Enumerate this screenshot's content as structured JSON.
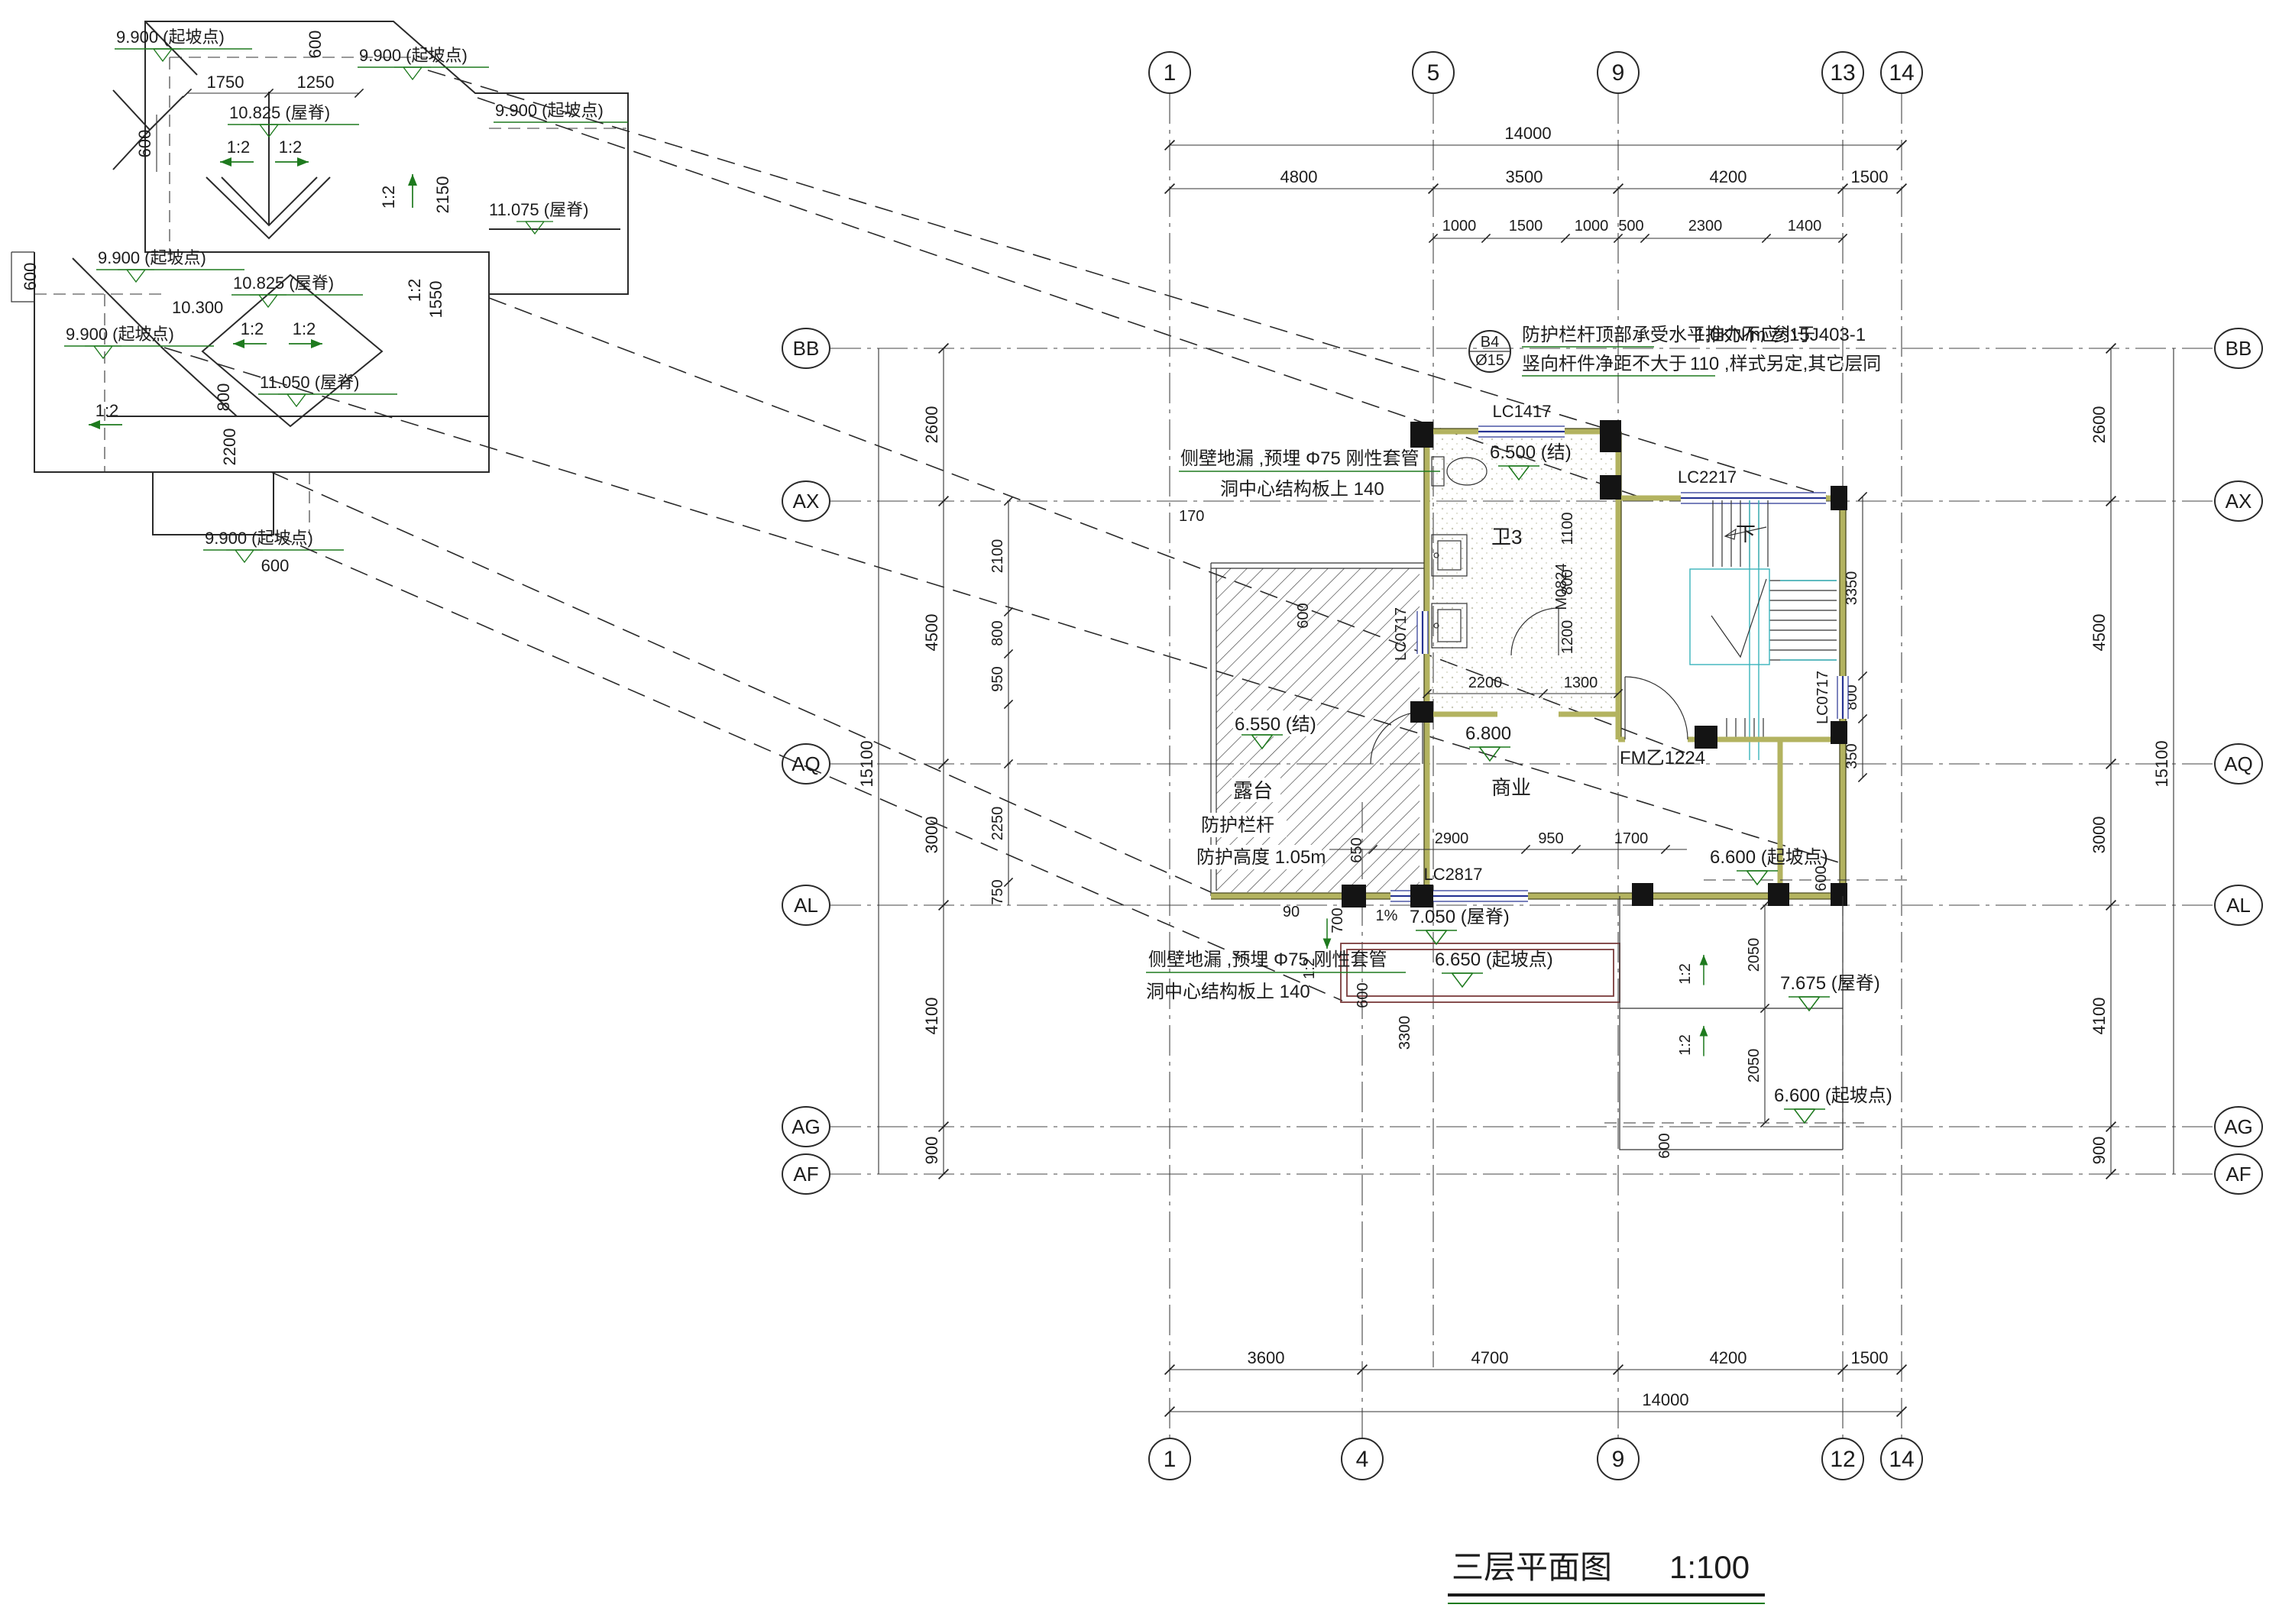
{
  "title": {
    "text": "三层平面图",
    "scale": "1:100"
  },
  "grid": {
    "t0": "1",
    "t1": "5",
    "t2": "9",
    "t3": "13",
    "t4": "14",
    "b0": "1",
    "b1": "4",
    "b2": "9",
    "b3": "12",
    "b4": "14",
    "l0": "BB",
    "l1": "AX",
    "l2": "AQ",
    "l3": "AL",
    "l4": "AG",
    "l5": "AF"
  },
  "dims": {
    "top_total": "14000",
    "bot_total": "14000",
    "t0": "4800",
    "t1": "3500",
    "t2": "4200",
    "t3": "1500",
    "s0": "1000",
    "s1": "1500",
    "s2": "1000",
    "s3": "500",
    "s4": "2300",
    "s5": "1400",
    "b0": "3600",
    "b1": "4700",
    "b2": "4200",
    "b3": "1500",
    "v_total": "15100",
    "v0": "2600",
    "v1": "4500",
    "v2": "3000",
    "v3": "4100",
    "v4": "900",
    "i0": "2100",
    "i1": "800",
    "i2": "950",
    "i3": "2250",
    "i4": "750",
    "r0": "3350",
    "r1": "800",
    "r2": "350",
    "rf0": "2050",
    "rf1": "2050",
    "p2200": "2200",
    "p1300": "1300",
    "p1200": "1200",
    "p1100": "1100",
    "p800": "800",
    "p2900": "2900",
    "p950": "950",
    "p1700": "1700",
    "p650": "650",
    "p90": "90",
    "p700": "700",
    "p600": "600",
    "p3300": "3300",
    "p170": "170",
    "p350": "350"
  },
  "rooms": {
    "bath": "卫3",
    "biz": "商业",
    "terrace": "露台",
    "down": "下"
  },
  "levels": {
    "v6500": "6.500 (结)",
    "v6550": "6.550 (结)",
    "v6800": "6.800",
    "v6600": "6.600 (起坡点)",
    "v6650": "6.650 (起坡点)",
    "v7050": "7.050 (屋脊)",
    "v7675": "7.675 (屋脊)"
  },
  "openings": {
    "lc1417": "LC1417",
    "lc2217": "LC2217",
    "lc0717": "LC0717",
    "lc2817": "LC2817",
    "m0824": "M0824",
    "fm": "FM乙1224"
  },
  "notes": {
    "bub_a": "B4",
    "bub_b": "Ø15",
    "n1": "防护栏杆顶部承受水平推力不应小于",
    "n1v": "1.0KN/m  参15J403-1",
    "n2": "竖向杆件净距不大于",
    "n2v": "110 ,样式另定,其它层同",
    "drain1": "侧壁地漏 ,预埋 Φ75 刚性套管",
    "drain2": "洞中心结构板上    140",
    "rail1": "防护栏杆",
    "rail2": "防护高度 1.05m",
    "slope": "1:2",
    "slope1p": "1%"
  },
  "roof": {
    "p9900": "9.900 (起坡点)",
    "p10825": "10.825 (屋脊)",
    "p11075": "11.075 (屋脊)",
    "p11050": "11.050 (屋脊)",
    "p10300": "10.300",
    "d600": "600",
    "d1750": "1750",
    "d1250": "1250",
    "d2150": "2150",
    "d1550": "1550",
    "d800": "800",
    "d2200": "2200"
  }
}
